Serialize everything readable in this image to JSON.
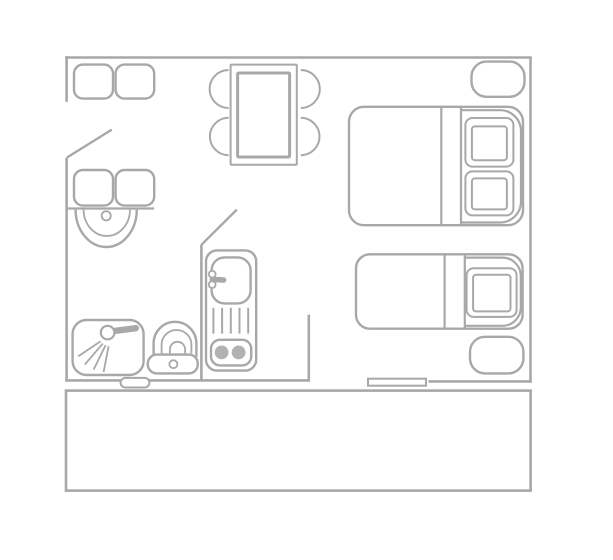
{
  "meta": {
    "width": 613,
    "height": 560,
    "kind": "apartment-floor-plan"
  },
  "palette": {
    "background": "#ffffff",
    "line": "#a8a8a8",
    "white": "#ffffff",
    "burner_fill": "#b2b2b2"
  },
  "floorplan": {
    "elements": [
      {
        "name": "top-wall",
        "shapes": [
          {
            "t": "line",
            "p": [
              65.2,
              57.5,
              531.8,
              57.5
            ],
            "w": 2.6
          }
        ]
      },
      {
        "name": "right-wall",
        "shapes": [
          {
            "t": "line",
            "p": [
              530.5,
              57.5,
              530.5,
              382.6
            ],
            "w": 2.6
          }
        ]
      },
      {
        "name": "left-wall-upper",
        "shapes": [
          {
            "t": "line",
            "p": [
              66.6,
              56.2,
              66.6,
              101.8
            ],
            "w": 2.6
          }
        ]
      },
      {
        "name": "left-wall-lower",
        "shapes": [
          {
            "t": "line",
            "p": [
              66.6,
              157.6,
              66.6,
              381.6
            ],
            "w": 2.6
          }
        ]
      },
      {
        "name": "entry-door-leaf",
        "shapes": [
          {
            "t": "line",
            "p": [
              67,
              157.5,
              111.8,
              129.6
            ],
            "w": 2.4
          }
        ]
      },
      {
        "name": "vanity-counter",
        "shapes": [
          {
            "t": "line",
            "p": [
              66,
              208.5,
              154,
              208.5
            ],
            "w": 2.2
          }
        ]
      },
      {
        "name": "kitchen-partition-wall",
        "shapes": [
          {
            "t": "line",
            "p": [
              201.4,
              244.8,
              201.4,
              380.4
            ],
            "w": 2.6
          }
        ]
      },
      {
        "name": "kitchen-door-leaf",
        "shapes": [
          {
            "t": "line",
            "p": [
              201.4,
              244.8,
              236.8,
              209.6
            ],
            "w": 2.4
          }
        ]
      },
      {
        "name": "living-partition-wall",
        "shapes": [
          {
            "t": "line",
            "p": [
              308.8,
              314.8,
              308.8,
              381.6
            ],
            "w": 2.6
          }
        ]
      },
      {
        "name": "bottom-wall-left",
        "shapes": [
          {
            "t": "line",
            "p": [
              65.2,
              380.4,
              310,
              380.4
            ],
            "w": 2.6
          }
        ]
      },
      {
        "name": "bathroom-door-threshold",
        "shapes": [
          {
            "t": "rect",
            "p": [
              120.6,
              377.9,
              28.8,
              9.6
            ],
            "r": 4.8,
            "f": "#ffffff",
            "w": 2
          }
        ]
      },
      {
        "name": "bottom-wall-right",
        "shapes": [
          {
            "t": "line",
            "p": [
              428.5,
              381.4,
              531.8,
              381.4
            ],
            "w": 2.6
          }
        ]
      },
      {
        "name": "balcony-window",
        "shapes": [
          {
            "t": "rect",
            "p": [
              368,
              378.7,
              58,
              7
            ],
            "f": "#ffffff",
            "w": 2
          }
        ]
      },
      {
        "name": "balcony-rail",
        "shapes": [
          {
            "t": "rect",
            "p": [
              66,
              390.6,
              464.6,
              100
            ],
            "w": 2.6
          }
        ]
      },
      {
        "name": "entry-closet-left",
        "shapes": [
          {
            "t": "rect",
            "p": [
              74,
              64.6,
              39,
              34
            ],
            "r": 9,
            "w": 2.4
          }
        ]
      },
      {
        "name": "entry-closet-right",
        "shapes": [
          {
            "t": "rect",
            "p": [
              115.6,
              64.6,
              38.6,
              34
            ],
            "r": 9,
            "w": 2.4
          }
        ]
      },
      {
        "name": "bathroom-cabinet-left",
        "shapes": [
          {
            "t": "rect",
            "p": [
              74,
              170,
              39,
              35.6
            ],
            "r": 9,
            "w": 2.4
          }
        ]
      },
      {
        "name": "bathroom-cabinet-right",
        "shapes": [
          {
            "t": "rect",
            "p": [
              115.6,
              170,
              38.6,
              35.6
            ],
            "r": 9,
            "w": 2.4
          }
        ]
      },
      {
        "name": "washbasin",
        "shapes": [
          {
            "t": "path",
            "d": "M75.6 209.6 A30.6 37.4 0 0 0 136.8 209.6",
            "w": 2.4
          },
          {
            "t": "path",
            "d": "M83.6 209.6 A23.2 26.4 0 0 0 130 209.6",
            "w": 1.8
          },
          {
            "t": "circle",
            "p": [
              106.2,
              215.8,
              4.6
            ],
            "w": 1.8
          }
        ]
      },
      {
        "name": "dining-table",
        "shapes": [
          {
            "t": "rect",
            "p": [
              230.6,
              64.6,
              66.2,
              100.2
            ],
            "r": 1,
            "w": 2
          },
          {
            "t": "rect",
            "p": [
              237.6,
              73,
              52,
              84
            ],
            "r": 1,
            "w": 3
          }
        ]
      },
      {
        "name": "dining-chair-top-left",
        "shapes": [
          {
            "t": "path",
            "d": "M228.6 70 A19 19 0 0 0 228.6 108",
            "w": 2
          }
        ]
      },
      {
        "name": "dining-chair-bottom-left",
        "shapes": [
          {
            "t": "path",
            "d": "M228.6 117.8 A18.7 18.7 0 0 0 228.6 155.2",
            "w": 2
          }
        ]
      },
      {
        "name": "dining-chair-top-right",
        "shapes": [
          {
            "t": "path",
            "d": "M300.8 70 A19 19 0 0 1 300.8 108",
            "w": 2
          }
        ]
      },
      {
        "name": "dining-chair-bottom-right",
        "shapes": [
          {
            "t": "path",
            "d": "M300.8 117.8 A18.7 18.7 0 0 1 300.8 155.2",
            "w": 2
          }
        ]
      },
      {
        "name": "double-bed",
        "shapes": [
          {
            "t": "rect",
            "p": [
              349,
              106.8,
              174,
              118.4
            ],
            "r": 15,
            "w": 2.4
          },
          {
            "t": "line",
            "p": [
              441.3,
              108,
              441.3,
              224
            ],
            "w": 2.2
          },
          {
            "t": "line",
            "p": [
              461,
              108,
              461,
              224
            ],
            "w": 2.2
          },
          {
            "t": "path",
            "d": "M461.5 110.2 H500 A21 20.9 0 0 1 521 131.1 V201.6 A21 20.9 0 0 1 500 222.5 H461.5",
            "w": 2.2
          },
          {
            "t": "rect",
            "p": [
              465.4,
              118,
              48,
              48.6
            ],
            "r": 7,
            "w": 2
          },
          {
            "t": "rect",
            "p": [
              471.9,
              126.4,
              35,
              33.8
            ],
            "r": 3,
            "w": 2
          },
          {
            "t": "rect",
            "p": [
              465.4,
              171.4,
              48,
              44
            ],
            "r": 7,
            "w": 2
          },
          {
            "t": "rect",
            "p": [
              471.9,
              178.4,
              35,
              31
            ],
            "r": 3,
            "w": 2
          }
        ]
      },
      {
        "name": "nightstand-top",
        "shapes": [
          {
            "t": "rect",
            "p": [
              471.5,
              61.6,
              53,
              35.2
            ],
            "r": 15,
            "w": 2.4
          }
        ]
      },
      {
        "name": "nightstand-bottom",
        "shapes": [
          {
            "t": "rect",
            "p": [
              470,
              336.8,
              53.4,
              36.6
            ],
            "r": 15,
            "w": 2.4
          }
        ]
      },
      {
        "name": "single-bed",
        "shapes": [
          {
            "t": "rect",
            "p": [
              356,
              254.3,
              166.6,
              74.4
            ],
            "r": 14,
            "w": 2.4
          },
          {
            "t": "line",
            "p": [
              444.6,
              255.5,
              444.6,
              328
            ],
            "w": 2.2
          },
          {
            "t": "line",
            "p": [
              464.8,
              255.5,
              464.8,
              328
            ],
            "w": 2.2
          },
          {
            "t": "path",
            "d": "M465.2 257.6 H502.4 A18.4 18.4 0 0 1 520.8 276 V307.4 A18.4 18.4 0 0 1 502.4 325.8 H465.2",
            "w": 2.2
          },
          {
            "t": "rect",
            "p": [
              466.6,
              268.3,
              50,
              48.6
            ],
            "r": 7,
            "w": 2
          },
          {
            "t": "rect",
            "p": [
              473.1,
              274.8,
              37.4,
              36.6
            ],
            "r": 3,
            "w": 2
          }
        ]
      },
      {
        "name": "shower",
        "shapes": [
          {
            "t": "rect",
            "p": [
              72.6,
              320,
              71,
              55
            ],
            "r": 14,
            "w": 2.4
          },
          {
            "t": "line",
            "p": [
              115.5,
              330.8,
              135.8,
              328.2
            ],
            "w": 6.4,
            "cap": "round"
          },
          {
            "t": "circle",
            "p": [
              107.6,
              332.6,
              6.8
            ],
            "f": "#ffffff",
            "w": 2.2
          },
          {
            "t": "line",
            "p": [
              100.6,
              341.2,
              78.2,
              356.4
            ],
            "w": 1.8
          },
          {
            "t": "line",
            "p": [
              102.8,
              343.6,
              84.8,
              364.6
            ],
            "w": 1.8
          },
          {
            "t": "line",
            "p": [
              105.6,
              345.2,
              93.6,
              369.6
            ],
            "w": 1.8
          },
          {
            "t": "line",
            "p": [
              108.6,
              346.2,
              103.6,
              372
            ],
            "w": 1.8
          }
        ]
      },
      {
        "name": "toilet",
        "shapes": [
          {
            "t": "path",
            "d": "M153.6 357 L153.6 343.4 A21.4 21.6 0 0 1 196.4 343.4 L196.4 357",
            "w": 2.4
          },
          {
            "t": "path",
            "d": "M161.6 353.4 L161.6 344.4 A14.9 14.4 0 0 1 191.4 344.4 L191.4 353.4",
            "w": 1.8
          },
          {
            "t": "path",
            "d": "M169.9 353.4 L169.9 349.4 A7.6 7.6 0 0 1 185.1 349.4 L185.1 353.4",
            "w": 1.8
          },
          {
            "t": "rect",
            "p": [
              147.8,
              354.6,
              50,
              18.8
            ],
            "r": 9,
            "f": "#ffffff",
            "w": 2.4
          },
          {
            "t": "circle",
            "p": [
              173.4,
              364.2,
              4
            ],
            "w": 1.8
          }
        ]
      },
      {
        "name": "kitchenette",
        "shapes": [
          {
            "t": "rect",
            "p": [
              206,
              250.4,
              50.2,
              120.2
            ],
            "r": 11,
            "w": 2.4
          },
          {
            "t": "rect",
            "p": [
              211.6,
              257.4,
              39,
              46
            ],
            "r": 13,
            "w": 2.4
          },
          {
            "t": "line",
            "p": [
              212.4,
              279.4,
              223.6,
              280
            ],
            "w": 5.6,
            "cap": "round"
          },
          {
            "t": "circle",
            "p": [
              212.2,
              274.2,
              3.4
            ],
            "f": "#ffffff",
            "w": 1.8
          },
          {
            "t": "circle",
            "p": [
              212.2,
              284.6,
              3.4
            ],
            "f": "#ffffff",
            "w": 1.8
          },
          {
            "t": "line",
            "p": [
              213.4,
              307.8,
              213.4,
              333.6
            ],
            "w": 2
          },
          {
            "t": "line",
            "p": [
              222.1,
              307.8,
              222.1,
              333.6
            ],
            "w": 2
          },
          {
            "t": "line",
            "p": [
              230.8,
              307.8,
              230.8,
              333.6
            ],
            "w": 2
          },
          {
            "t": "line",
            "p": [
              239.5,
              307.8,
              239.5,
              333.6
            ],
            "w": 2
          },
          {
            "t": "line",
            "p": [
              248.2,
              307.8,
              248.2,
              333.6
            ],
            "w": 2
          },
          {
            "t": "rect",
            "p": [
              211,
              339.8,
              40.2,
              25.6
            ],
            "r": 9,
            "w": 2.4
          },
          {
            "t": "circle",
            "p": [
              221.6,
              352.4,
              6.9
            ],
            "f": "#b2b2b2",
            "ns": true
          },
          {
            "t": "circle",
            "p": [
              238.6,
              352.4,
              6.9
            ],
            "f": "#b2b2b2",
            "ns": true
          }
        ]
      }
    ]
  }
}
